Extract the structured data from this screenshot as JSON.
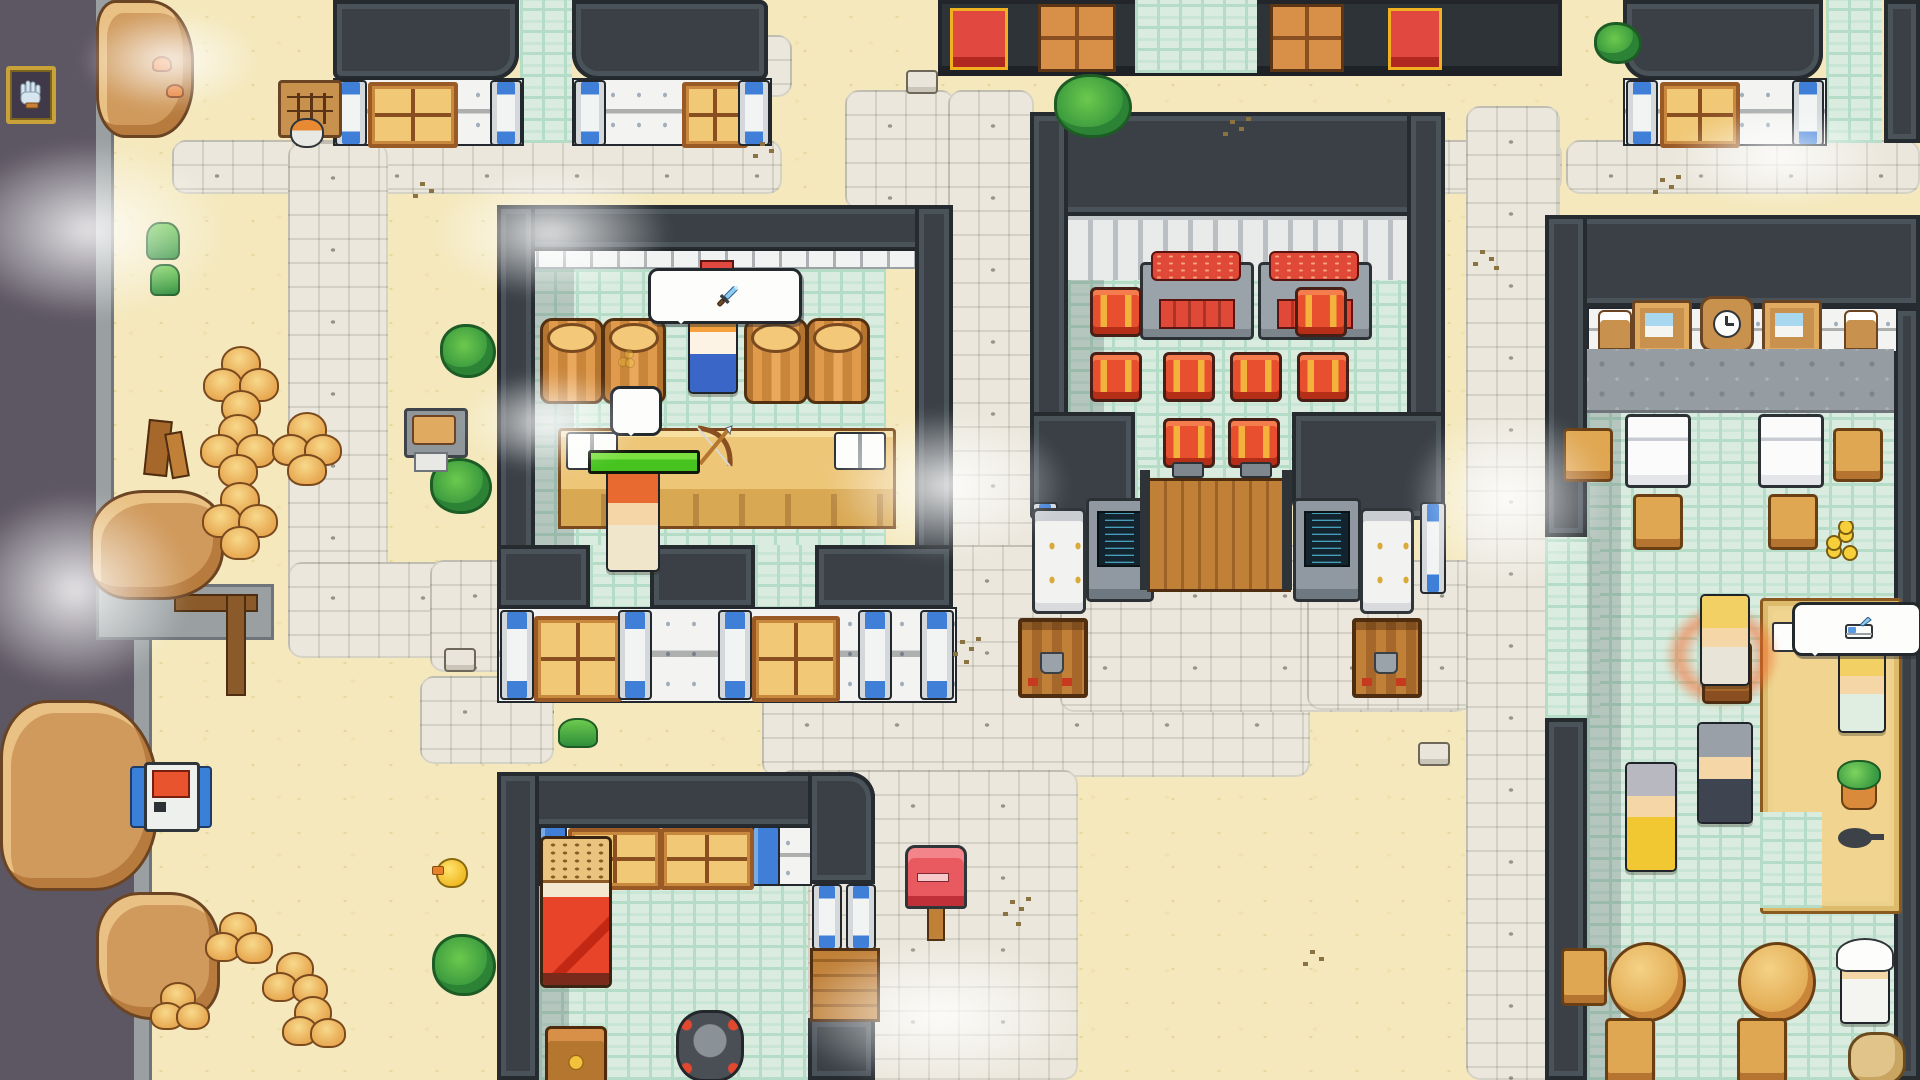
{
  "hud": {
    "coin_counter": {
      "value": "58",
      "icon": "coin-stack-icon"
    },
    "event_message": "YOU SOLD A RUSTED SWORD",
    "hand_button_icon": "hand-cursor-icon"
  },
  "labels": {
    "shop_sign": "SHOP",
    "inn_sign": "INN",
    "counter_sell": "SELL",
    "counter_jobs": "JOBS",
    "coin_popup": "58",
    "music_note": "♪"
  },
  "icons": {
    "shop_sign": "sword-icon",
    "inn_sign": "bed-icon",
    "counter_left": "open-book-icon",
    "counter_center": "bow-arrow-icon",
    "counter_right": "open-book-icon",
    "speech_bubble": "music-note-icon"
  },
  "player": {
    "health_bar_percent": 100
  },
  "colors": {
    "sand": "#f4e8bc",
    "path_gray": "#ebe7dc",
    "floor_teal": "#d9ecdf",
    "wall_dark": "#3a4046",
    "trim_white": "#f1f3f2",
    "void_purple": "#5d5663",
    "accent_red": "#cf3126",
    "message_red": "#e8483c",
    "coin_yellow": "#f7d53a",
    "hp_green": "#46c31e"
  }
}
